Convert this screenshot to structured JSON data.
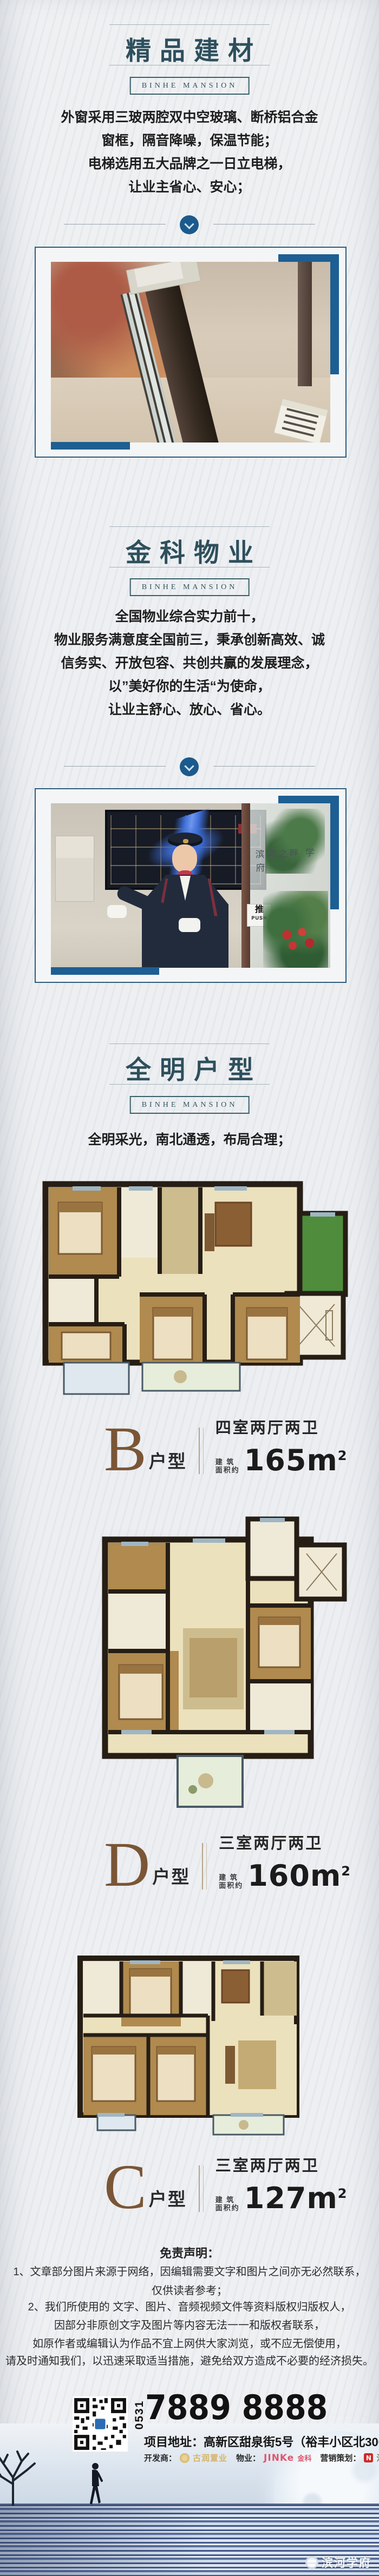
{
  "brand": {
    "badge": "BINHE MANSION",
    "watermark": "滨河学府"
  },
  "colors": {
    "accent_blue": "#1d5e93",
    "title_teal": "#2e4f5c",
    "plan_letter_brown": "#7a5636",
    "jinke_red": "#e0566e",
    "marketing_red": "#cc2a2a",
    "developer_gold": "#d5b469"
  },
  "sections": {
    "materials": {
      "title": "精品建材",
      "lines": [
        "外窗采用三玻两腔双中空玻璃、断桥铝合金",
        "窗框，隔音降噪，保温节能；",
        "电梯选用五大品牌之一日立电梯，",
        "让业主省心、安心；"
      ]
    },
    "property": {
      "title": "金科物业",
      "lines": [
        "全国物业综合实力前十，",
        "物业服务满意度全国前三，秉承创新高效、诚",
        "信务实、开放包容、共创共赢的发展理念，",
        "以”美好你的生活“为使命，",
        "让业主舒心、放心、省心。"
      ]
    },
    "floorplans": {
      "title": "全明户型",
      "intro": "全明采光，南北通透，布局合理；"
    }
  },
  "photos": {
    "concierge": {
      "glass_text": "滨河之畔 学府",
      "push_cn": "推",
      "push_en": "PUSH"
    }
  },
  "plans": [
    {
      "letter": "B",
      "suffix": "户型",
      "rooms": "四室两厅两卫",
      "area_label_top": "建  筑",
      "area_label_bottom": "面积约",
      "area_value": "165m",
      "area_sup": "2"
    },
    {
      "letter": "D",
      "suffix": "户型",
      "rooms": "三室两厅两卫",
      "area_label_top": "建  筑",
      "area_label_bottom": "面积约",
      "area_value": "160m",
      "area_sup": "2"
    },
    {
      "letter": "C",
      "suffix": "户型",
      "rooms": "三室两厅两卫",
      "area_label_top": "建  筑",
      "area_label_bottom": "面积约",
      "area_value": "127m",
      "area_sup": "2"
    }
  ],
  "disclaimer": {
    "heading": "免责声明：",
    "lines": [
      "1、文章部分图片来源于网络，因编辑需要文字和图片之间亦无必然联系，",
      "仅供读者参考；",
      "2、我们所使用的 文字、图片、音频视频文件等资料版权归版权人，",
      "因部分非原创文字及图片等内容无法一一和版权者联系，",
      "如原作者或编辑认为作品不宜上网供大家浏览，或不应无偿使用，",
      "请及时通知我们，以迅速采取适当措施，避免给双方造成不必要的经济损失。"
    ]
  },
  "contact": {
    "area_code": "0531",
    "phone": "7889 8888",
    "address": "项目地址：高新区甜泉街5号（裕丰小区北300米）",
    "developer_label": "开发商：",
    "developer_name": "古润置业",
    "pm_label": "物业：",
    "pm_brand": "JINKe",
    "pm_brand_suffix": "金科",
    "marketing_label": "营销策划：",
    "marketing_logo_letter": "N",
    "marketing_name": "浩华地产（济南）"
  }
}
